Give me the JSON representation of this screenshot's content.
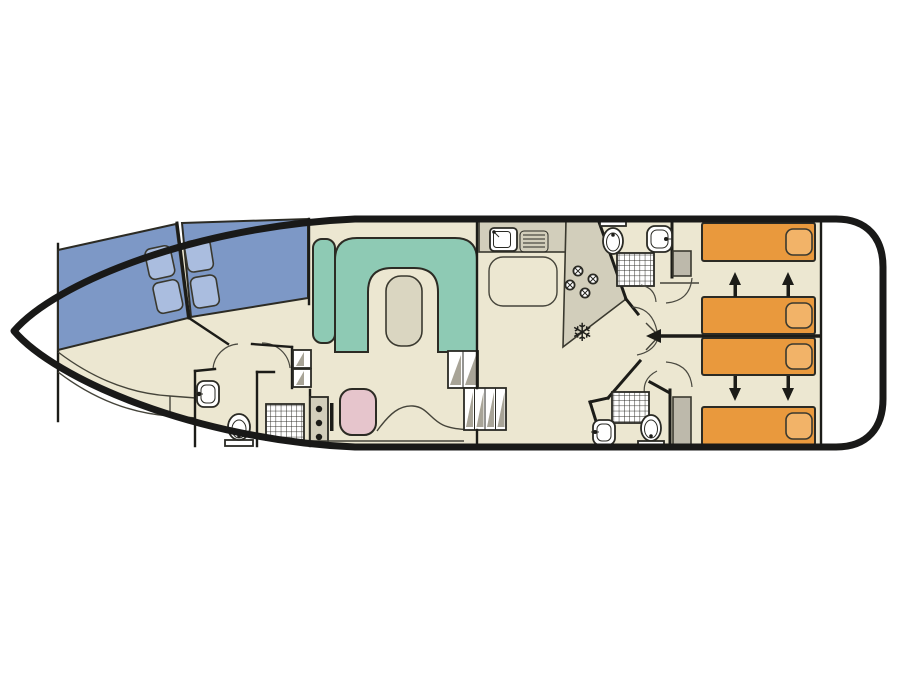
{
  "diagram": {
    "kind": "canal-boat floor plan, top view, bow left / stern right"
  },
  "icons": {
    "snowflake": "❄"
  },
  "colors": {
    "floor": "#ece7d1",
    "deck_white": "#ffffff",
    "hull_outline": "#191918",
    "counter_grey": "#d2cebb",
    "bed_blue": "#7d98c6",
    "pillow_blue": "#aabddf",
    "sofa_green": "#8ecab4",
    "table_beige": "#dad6c1",
    "bed_orange": "#e9993d",
    "pillow_orange": "#f2b368",
    "seat_pink": "#e6c5cc",
    "wardrobe_grey": "#bdb9ab",
    "step_grey": "#a8a497",
    "fixture_white": "#ffffff",
    "arrow_black": "#1c1c18"
  },
  "features": {
    "bow_cabin": {
      "double_beds": 2,
      "pillows": 4,
      "curved_bench": 1
    },
    "front_bathroom": {
      "toilet": 1,
      "washbasin": 1,
      "shower": 1
    },
    "saloon": {
      "u_shaped_sofa": 1,
      "table": 1,
      "helm_seat": 1,
      "helm_console_knobs": 3
    },
    "galley": {
      "sink": 1,
      "drainer": 1,
      "stove_burners": 4,
      "fridge": 1
    },
    "aft_bathrooms": {
      "count": 2,
      "toilets": 2,
      "washbasins": 2,
      "showers": 2
    },
    "aft_cabins": {
      "single_beds": 4,
      "sliding_bed_arrows": 4,
      "wardrobes": 2
    },
    "companionway_steps": 3
  }
}
